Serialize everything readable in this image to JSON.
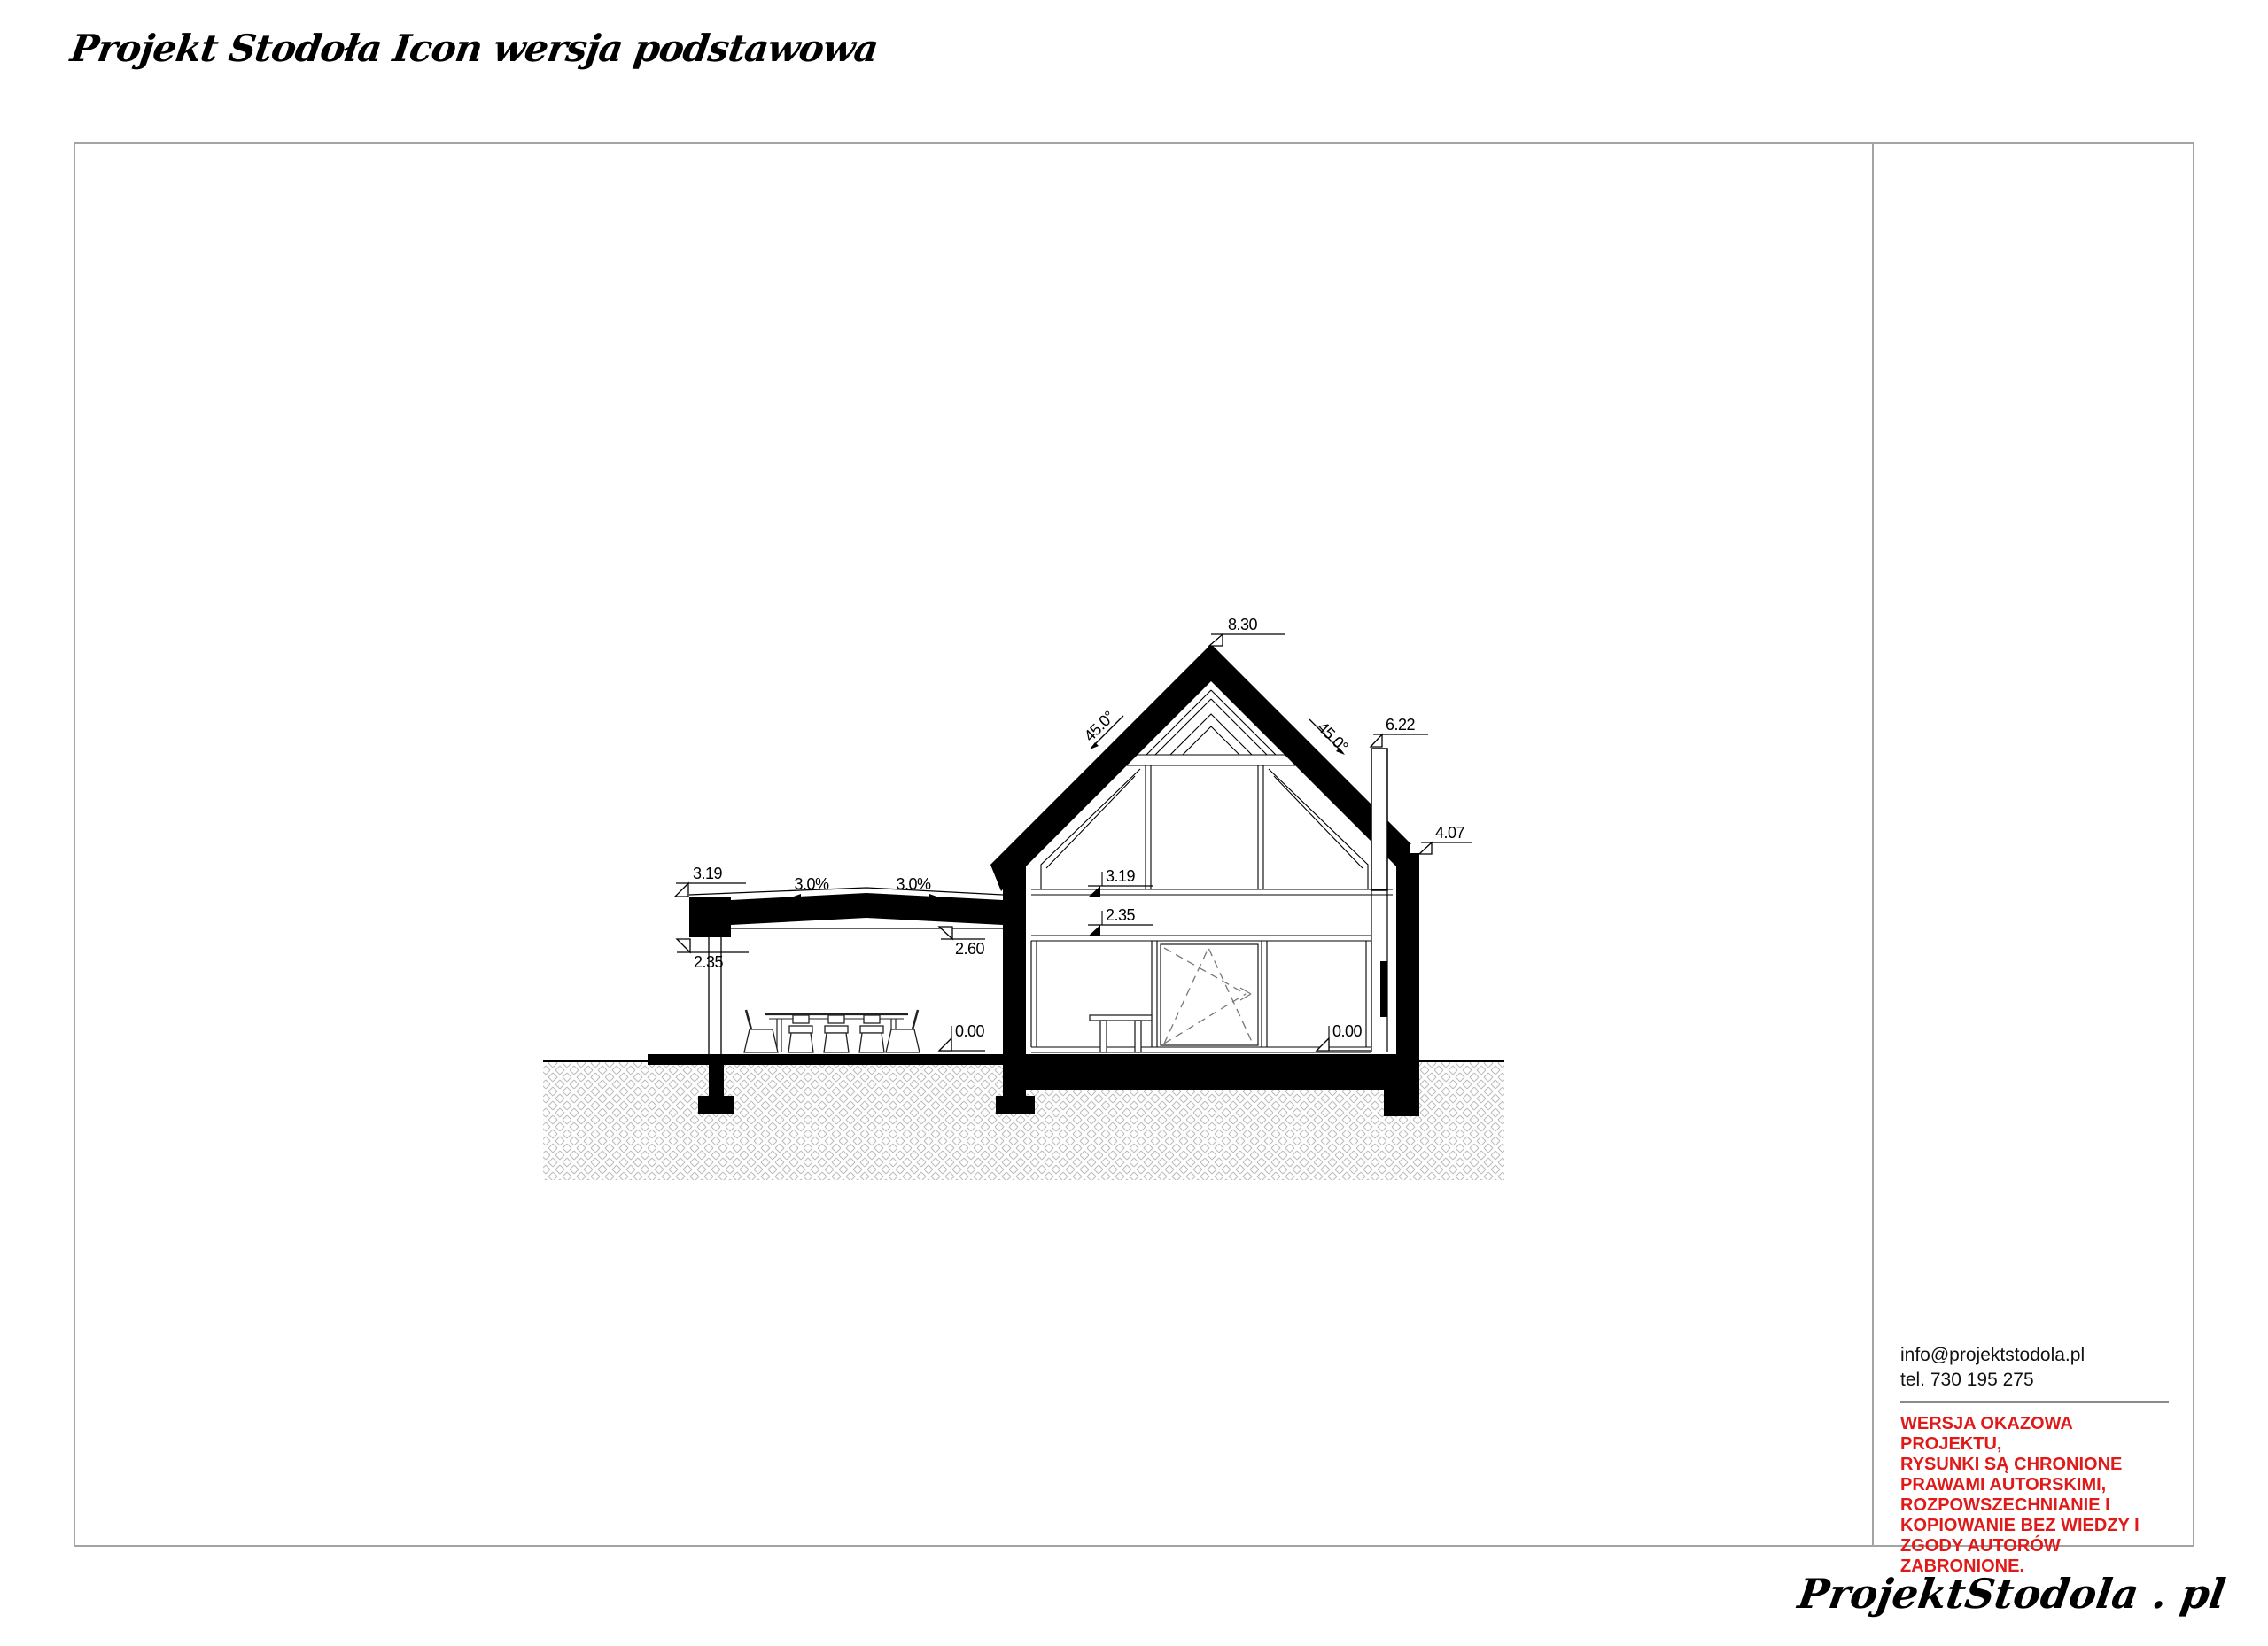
{
  "header": {
    "title": "Projekt Stodoła Icon wersja podstawowa"
  },
  "sidebar": {
    "email": "info@projektstodola.pl",
    "phone": "tel. 730 195 275",
    "warning_lines": [
      "WERSJA OKAZOWA PROJEKTU,",
      "RYSUNKI  SĄ CHRONIONE",
      "PRAWAMI AUTORSKIMI,",
      "ROZPOWSZECHNIANIE I",
      "KOPIOWANIE BEZ WIEDZY I",
      "ZGODY AUTORÓW ZABRONIONE."
    ]
  },
  "footer": {
    "logo": "ProjektStodola . pl"
  },
  "drawing": {
    "levels": {
      "ridge": "8.30",
      "chimney_top": "6.22",
      "eaves": "4.07",
      "canopy_top": "3.19",
      "canopy_edge_bottom": "2.35",
      "canopy_ceiling": "2.60",
      "terrace_floor": "0.00",
      "upper_floor": "3.19",
      "glazing_top": "2.35",
      "ground_floor": "0.00"
    },
    "slopes": {
      "roof_left": "45.0°",
      "roof_right": "45.0°",
      "canopy_fall_left": "3.0%",
      "canopy_fall_right": "3.0%"
    }
  },
  "colors": {
    "warning_red": "#e01919",
    "frame_gray": "#a3a3a3",
    "hatch_gray": "#bdbdbd",
    "ink": "#000000"
  }
}
